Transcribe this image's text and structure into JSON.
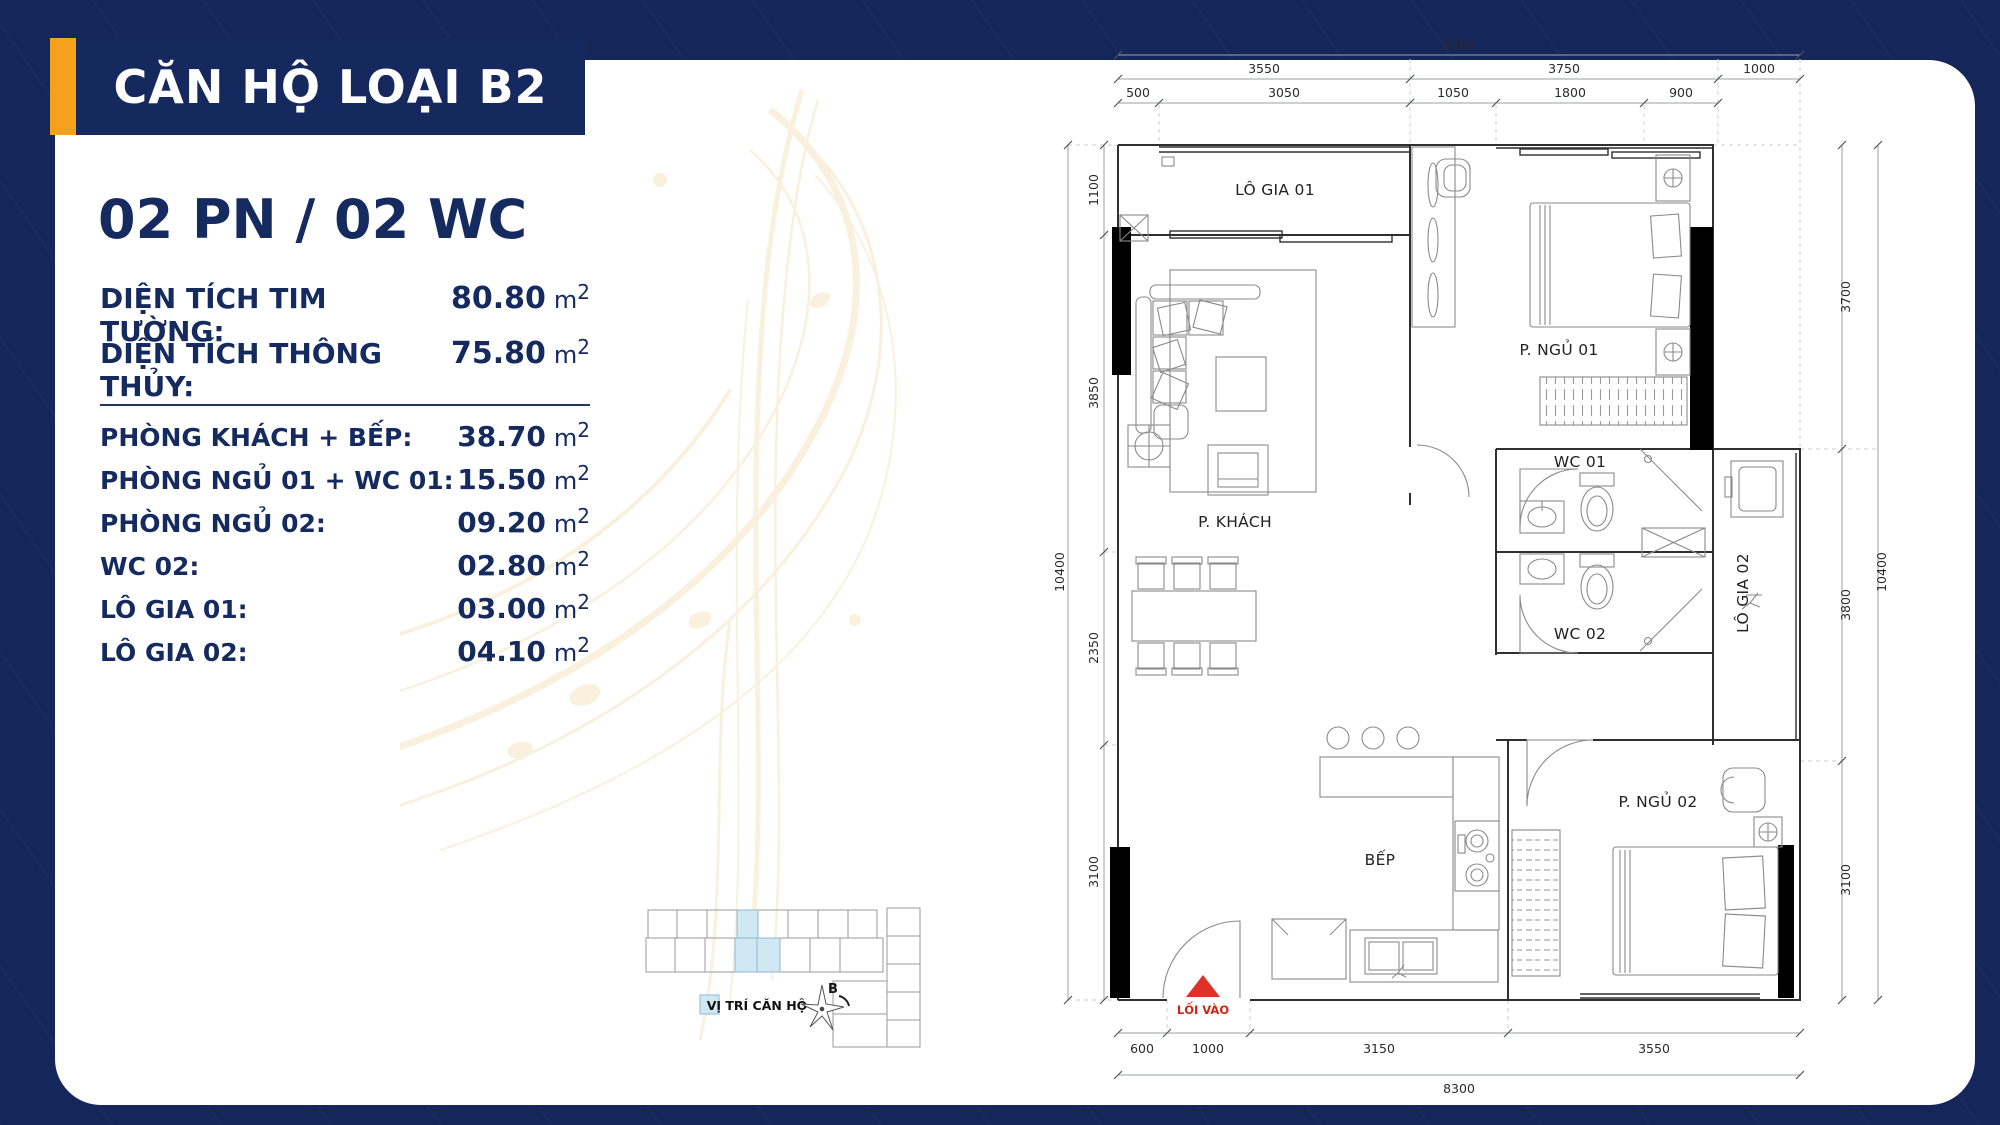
{
  "title": "CĂN HỘ LOẠI B2",
  "subtitle": "02 PN / 02 WC",
  "units": {
    "m": "m",
    "sup": "2"
  },
  "theme": {
    "bg": "#14265a",
    "card": "#ffffff",
    "accent_orange": "#f5a11c",
    "banner_navy": "#16295f",
    "text_navy": "#152a5e",
    "highlight_blue": "#cfe8f4",
    "entrance_red": "#e03127"
  },
  "specs": {
    "primary": [
      {
        "label": "DIỆN TÍCH TIM TƯỜNG:",
        "value": "80.80"
      },
      {
        "label": "DIỆN TÍCH THÔNG THỦY:",
        "value": "75.80"
      }
    ],
    "rooms": [
      {
        "label": "PHÒNG KHÁCH + BẾP:",
        "value": "38.70"
      },
      {
        "label": "PHÒNG NGỦ 01 + WC 01:",
        "value": "15.50"
      },
      {
        "label": "PHÒNG NGỦ 02:",
        "value": "09.20"
      },
      {
        "label": "WC 02:",
        "value": "02.80"
      },
      {
        "label": "LÔ GIA 01:",
        "value": "03.00"
      },
      {
        "label": "LÔ GIA 02:",
        "value": "04.10"
      }
    ]
  },
  "locator": {
    "legend_label": "VỊ TRÍ CĂN HỘ",
    "compass_label": "B"
  },
  "floorplan": {
    "rooms": {
      "logia1": "LÔ GIA 01",
      "bedroom1": "P. NGỦ 01",
      "wc1": "WC 01",
      "living": "P. KHÁCH",
      "wc2": "WC 02",
      "logia2": "LÔ GIA 02",
      "kitchen": "BẾP",
      "bedroom2": "P. NGỦ 02"
    },
    "entrance_label": "LỐI VÀO",
    "dims": {
      "top_overall": "8300",
      "top_mid": [
        "3550",
        "3750",
        "1000"
      ],
      "top_inner": [
        "500",
        "3050",
        "1050",
        "1800",
        "900"
      ],
      "left_overall": "10400",
      "left": [
        "1100",
        "3850",
        "2350",
        "3100"
      ],
      "right_overall": "10400",
      "right": [
        "3700",
        "3800",
        "3100"
      ],
      "bottom": [
        "600",
        "1000",
        "3150",
        "3550"
      ],
      "bottom_overall": "8300"
    }
  }
}
